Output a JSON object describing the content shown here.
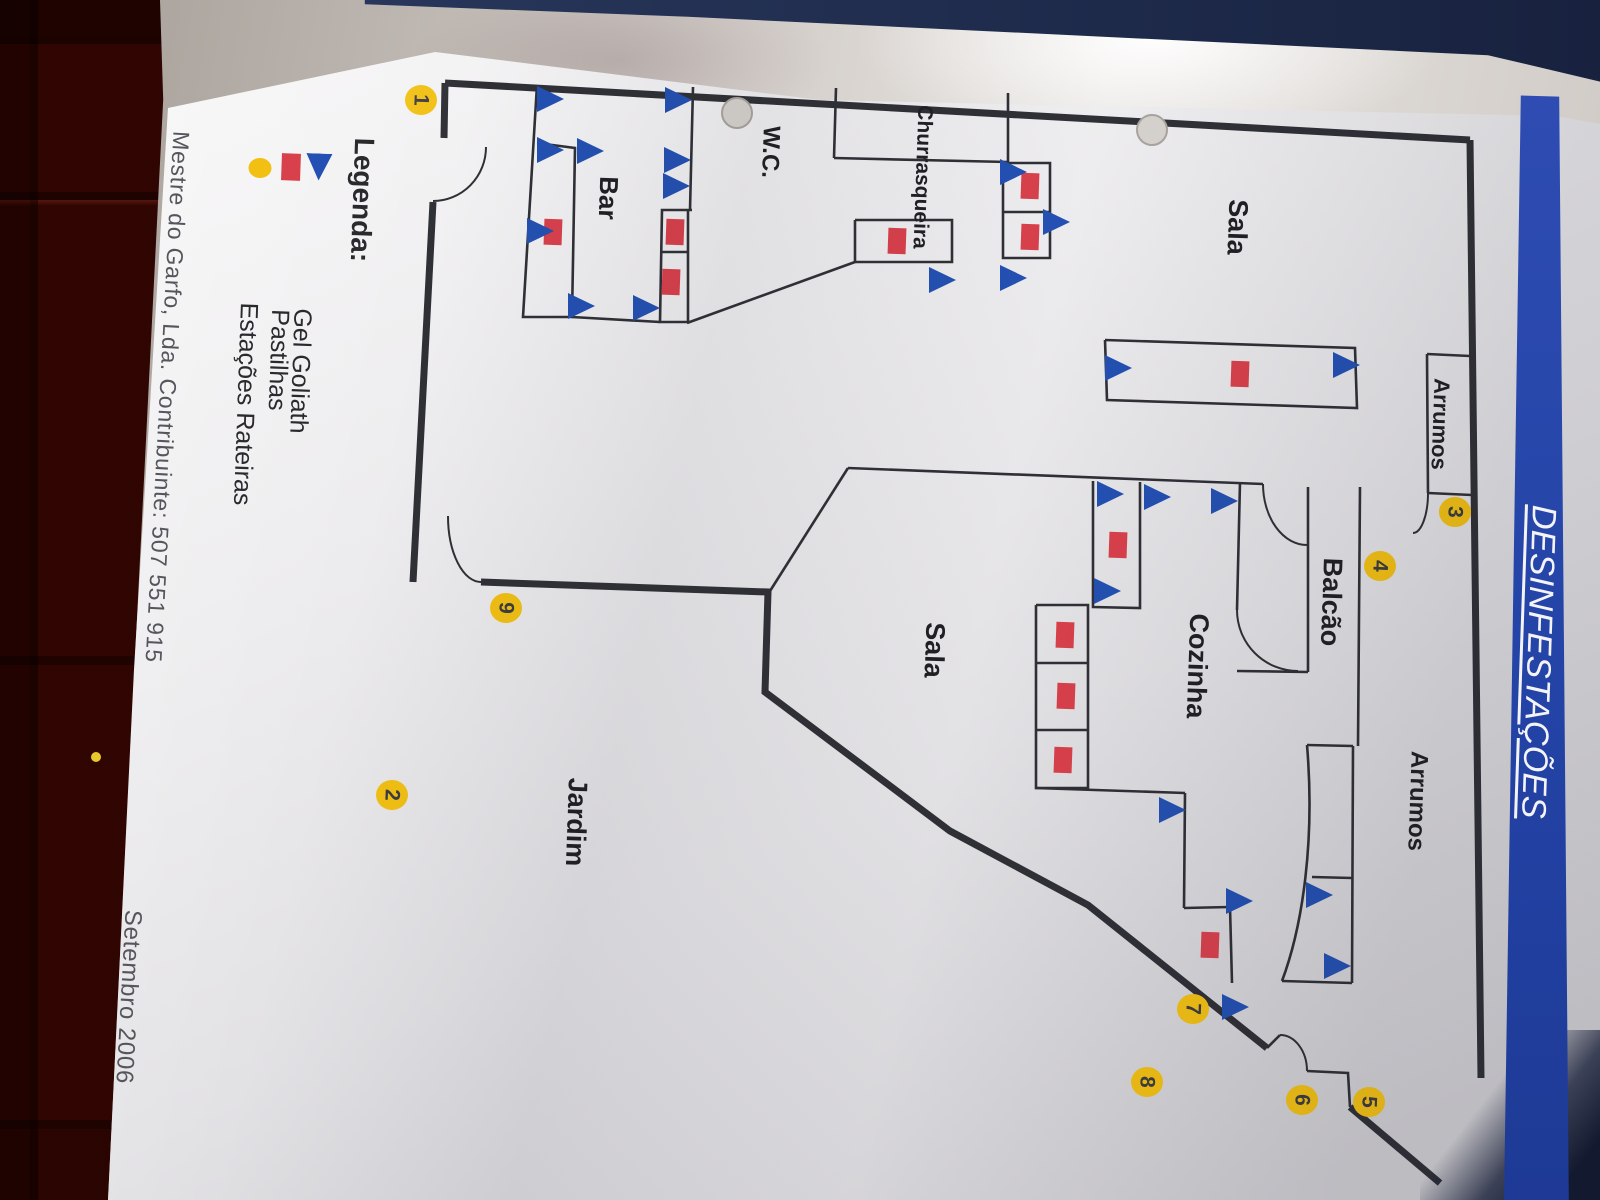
{
  "title": "DESINFESTAÇÕES",
  "legend": {
    "heading": "Legenda:",
    "items": [
      {
        "label": "Gel Goliath",
        "symbol": "triangle",
        "color": "#2350b2"
      },
      {
        "label": "Pastilhas",
        "symbol": "square",
        "color": "#d8404b"
      },
      {
        "label": "Estações Rateiras",
        "symbol": "circle",
        "color": "#f2c013"
      }
    ]
  },
  "footer": {
    "company": "Mestre do Garfo, Lda. Contribuinte: 507 551 915",
    "date": "Setembro 2006"
  },
  "colors": {
    "wall": "#2f3036",
    "marker_blue": "#2350b2",
    "marker_red": "#d8404b",
    "station_yellow": "#f2c013",
    "station_text": "#3c3c40",
    "banner_blue": "#2b49ac",
    "paper": "#ececee",
    "hole_fill": "#d6d2cd",
    "hole_rim": "#a9a49d"
  },
  "rooms": [
    {
      "id": "sala-top",
      "label": "Sala",
      "x": 1237,
      "y": 227,
      "fs": 27
    },
    {
      "id": "arrumos-top",
      "label": "Arrumos",
      "x": 1440,
      "y": 424,
      "fs": 22
    },
    {
      "id": "balcao",
      "label": "Balcão",
      "x": 1331,
      "y": 602,
      "fs": 27
    },
    {
      "id": "cozinha",
      "label": "Cozinha",
      "x": 1197,
      "y": 666,
      "fs": 27
    },
    {
      "id": "arrumos-bottom",
      "label": "Arrumos",
      "x": 1417,
      "y": 801,
      "fs": 24
    },
    {
      "id": "sala-middle",
      "label": "Sala",
      "x": 934,
      "y": 650,
      "fs": 27
    },
    {
      "id": "jardim",
      "label": "Jardim",
      "x": 576,
      "y": 822,
      "fs": 27
    },
    {
      "id": "wc",
      "label": "W.C.",
      "x": 770,
      "y": 152,
      "fs": 24
    },
    {
      "id": "churrasqueira",
      "label": "Churrasqueira",
      "x": 922,
      "y": 177,
      "fs": 21
    },
    {
      "id": "bar",
      "label": "Bar",
      "x": 608,
      "y": 198,
      "fs": 26
    }
  ],
  "stations": [
    {
      "n": "1",
      "x": 421,
      "y": 100
    },
    {
      "n": "2",
      "x": 392,
      "y": 795
    },
    {
      "n": "3",
      "x": 1455,
      "y": 512
    },
    {
      "n": "4",
      "x": 1380,
      "y": 566
    },
    {
      "n": "5",
      "x": 1369,
      "y": 1102
    },
    {
      "n": "6",
      "x": 1302,
      "y": 1100
    },
    {
      "n": "7",
      "x": 1193,
      "y": 1009
    },
    {
      "n": "8",
      "x": 1147,
      "y": 1082
    },
    {
      "n": "9",
      "x": 506,
      "y": 608
    }
  ],
  "markers": {
    "triangles": [
      [
        549,
        99
      ],
      [
        549,
        150
      ],
      [
        589,
        151
      ],
      [
        539,
        231
      ],
      [
        580,
        306
      ],
      [
        645,
        308
      ],
      [
        677,
        100
      ],
      [
        676,
        160
      ],
      [
        675,
        186
      ],
      [
        941,
        280
      ],
      [
        1012,
        172
      ],
      [
        1055,
        222
      ],
      [
        1012,
        278
      ],
      [
        1117,
        368
      ],
      [
        1345,
        365
      ],
      [
        1109,
        494
      ],
      [
        1156,
        497
      ],
      [
        1223,
        501
      ],
      [
        1106,
        591
      ],
      [
        1171,
        810
      ],
      [
        1238,
        901
      ],
      [
        1234,
        1007
      ],
      [
        1318,
        895
      ],
      [
        1336,
        966
      ]
    ],
    "squares": [
      [
        553,
        232
      ],
      [
        675,
        232
      ],
      [
        671,
        282
      ],
      [
        897,
        241
      ],
      [
        1030,
        186
      ],
      [
        1030,
        237
      ],
      [
        1240,
        374
      ],
      [
        1118,
        545
      ],
      [
        1065,
        635
      ],
      [
        1066,
        696
      ],
      [
        1063,
        760
      ],
      [
        1210,
        945
      ]
    ]
  },
  "walls": {
    "thick": [
      "M445,83 L1470,140",
      "M1470,140 L1481,1078",
      "M445,83 L444,138",
      "M433,202 L413,582",
      "M481,582 L768,592 L765,692 L950,831 L1088,905 L1267,1048",
      "M1350,1107 L1440,1183"
    ],
    "thin": [
      "M537,85 L523,317 L572,317 L575,148 L537,143",
      "M572,317 L660,322",
      "M693,87 L690,210",
      "M692,210 L662,210 L660,322 L688,322 L688,210",
      "M661,252 L688,252",
      "M687,323 L855,262",
      "M836,88 L834,158",
      "M834,158 L1008,162",
      "M1008,93 L1008,162",
      "M855,220 L952,220 L952,262 L855,262 L855,220",
      "M1003,163 L1050,163 L1050,258 L1003,258 L1003,163",
      "M1003,212 L1050,212",
      "M1105,340 L1355,348 L1357,408 L1107,400 L1105,340",
      "M848,468 L1263,484",
      "M848,468 L770,591",
      "M1240,482 L1237,610",
      "M1308,487 L1308,672",
      "M1360,487 L1358,746",
      "M1237,671 L1308,672",
      "M1427,354 L1470,356",
      "M1427,354 L1428,493",
      "M1428,493 L1472,495",
      "M1093,481 L1093,607 L1140,608 L1140,482",
      "M1036,605 L1088,605 L1088,788 L1036,788 L1036,605",
      "M1036,663 L1088,663",
      "M1036,730 L1088,730",
      "M1035,788 L1185,793",
      "M1185,793 L1184,908",
      "M1184,908 L1230,907",
      "M1230,907 L1232,983",
      "M1307,745 L1353,746",
      "M1353,746 L1352,983",
      "M1312,877 L1352,878",
      "M1282,981 L1352,983",
      "M1307,745 C1315,840 1303,925 1282,981",
      "M1267,1048 L1280,1035",
      "M1307,1071 L1348,1073 L1350,1107"
    ],
    "arcs": [
      "M486,147 A53,54 0 0 1 433,201",
      "M448,516 A33,66 0 0 0 481,582",
      "M1263,484 A44,61 0 0 0 1307,545",
      "M1428,493 A15,40 0 0 1 1413,533",
      "M1237,610 A61,61 0 0 0 1298,671",
      "M1280,1035 A27,36 0 0 1 1307,1071"
    ]
  },
  "paper_artifacts": {
    "punch_holes": [
      [
        737,
        113
      ],
      [
        1152,
        130
      ]
    ],
    "floor_speck": [
      96,
      757
    ]
  }
}
